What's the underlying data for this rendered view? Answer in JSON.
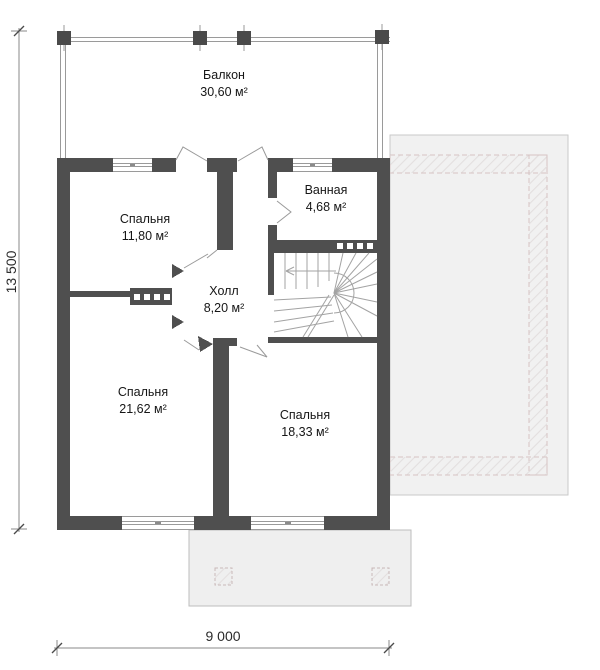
{
  "title": "Floor plan, second storey",
  "rooms": {
    "balcony": {
      "name": "Балкон",
      "area": "30,60 м²"
    },
    "bedroom1": {
      "name": "Спальня",
      "area": "11,80 м²"
    },
    "bathroom": {
      "name": "Ванная",
      "area": "4,68 м²"
    },
    "hall": {
      "name": "Холл",
      "area": "8,20 м²"
    },
    "bedroom2": {
      "name": "Спальня",
      "area": "21,62 м²"
    },
    "bedroom3": {
      "name": "Спальня",
      "area": "18,33 м²"
    }
  },
  "dimensions": {
    "vertical": "13 500",
    "horizontal": "9 000"
  },
  "colors": {
    "wall": "#4f4f4f",
    "thin-line": "#9a9a9a",
    "roof-fill": "#f1f1f1",
    "porch-fill": "#efefef",
    "text": "#161616"
  }
}
